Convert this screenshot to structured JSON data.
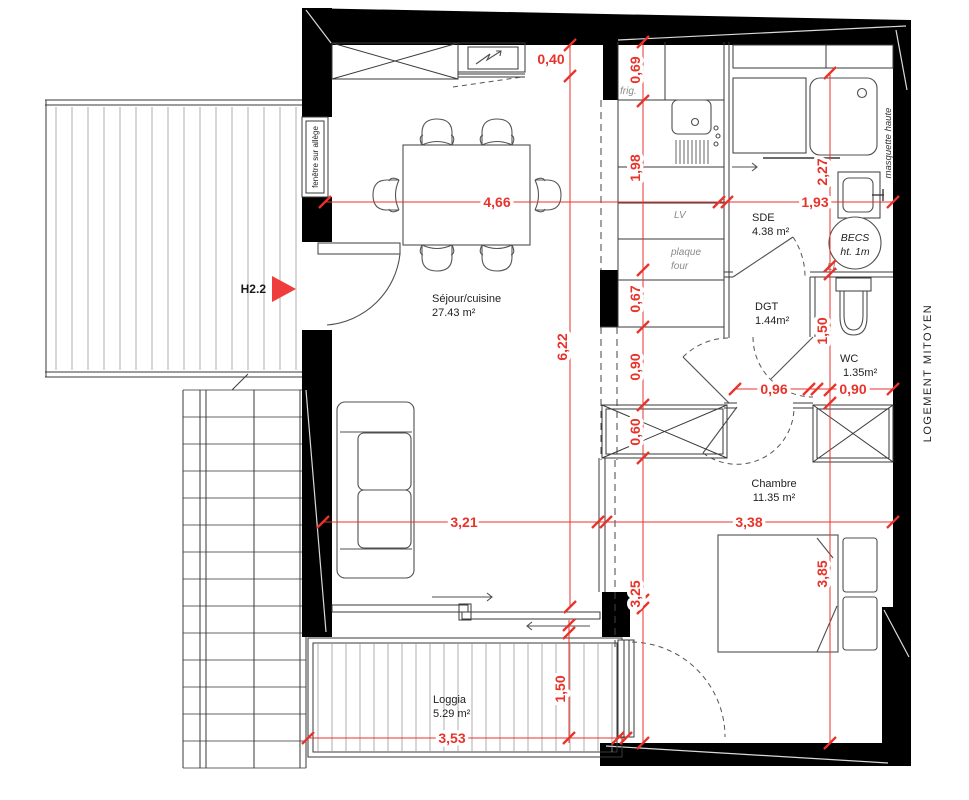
{
  "plan": {
    "rooms": {
      "sejour": {
        "name": "Séjour/cuisine",
        "area": "27.43 m²"
      },
      "sde": {
        "name": "SDE",
        "area": "4.38 m²"
      },
      "dgt": {
        "name": "DGT",
        "area": "1.44m²"
      },
      "wc": {
        "name": "WC",
        "area": "1.35m²"
      },
      "chambre": {
        "name": "Chambre",
        "area": "11.35 m²"
      },
      "loggia": {
        "name": "Loggia",
        "area": "5.29 m²"
      }
    },
    "annotations": {
      "frig": "frig.",
      "lv": "LV",
      "plaque_line1": "plaque",
      "plaque_line2": "four",
      "ll": "LL",
      "becs_line1": "BECS",
      "becs_line2": "ht. 1m",
      "masquette": "masquette haute",
      "logement": "LOGEMENT MITOYEN",
      "fenetre": "fenêtre sur allège",
      "h22": "H2.2"
    },
    "dimensions": {
      "cabinet_depth": "0,40",
      "frigo": "0,69",
      "kitchen_run": "1,98",
      "sejour_width": "4,66",
      "sde_width": "1,93",
      "sde_depth": "2,27",
      "sejour_height": "6,22",
      "k_bottom": "0,67",
      "k_passage": "0,90",
      "closet_depth": "0,60",
      "dgt_width": "0,96",
      "wc_width": "0,90",
      "wc_depth": "1,50",
      "sejour_lower": "3,21",
      "chambre_width": "3,38",
      "chambre_height": "3,85",
      "chambre_left": "3,25",
      "loggia_depth": "1,50",
      "loggia_width": "3,53"
    },
    "colors": {
      "dimension": "#e8332b",
      "arrow": "#ee3d3b",
      "wall": "#000000"
    }
  }
}
